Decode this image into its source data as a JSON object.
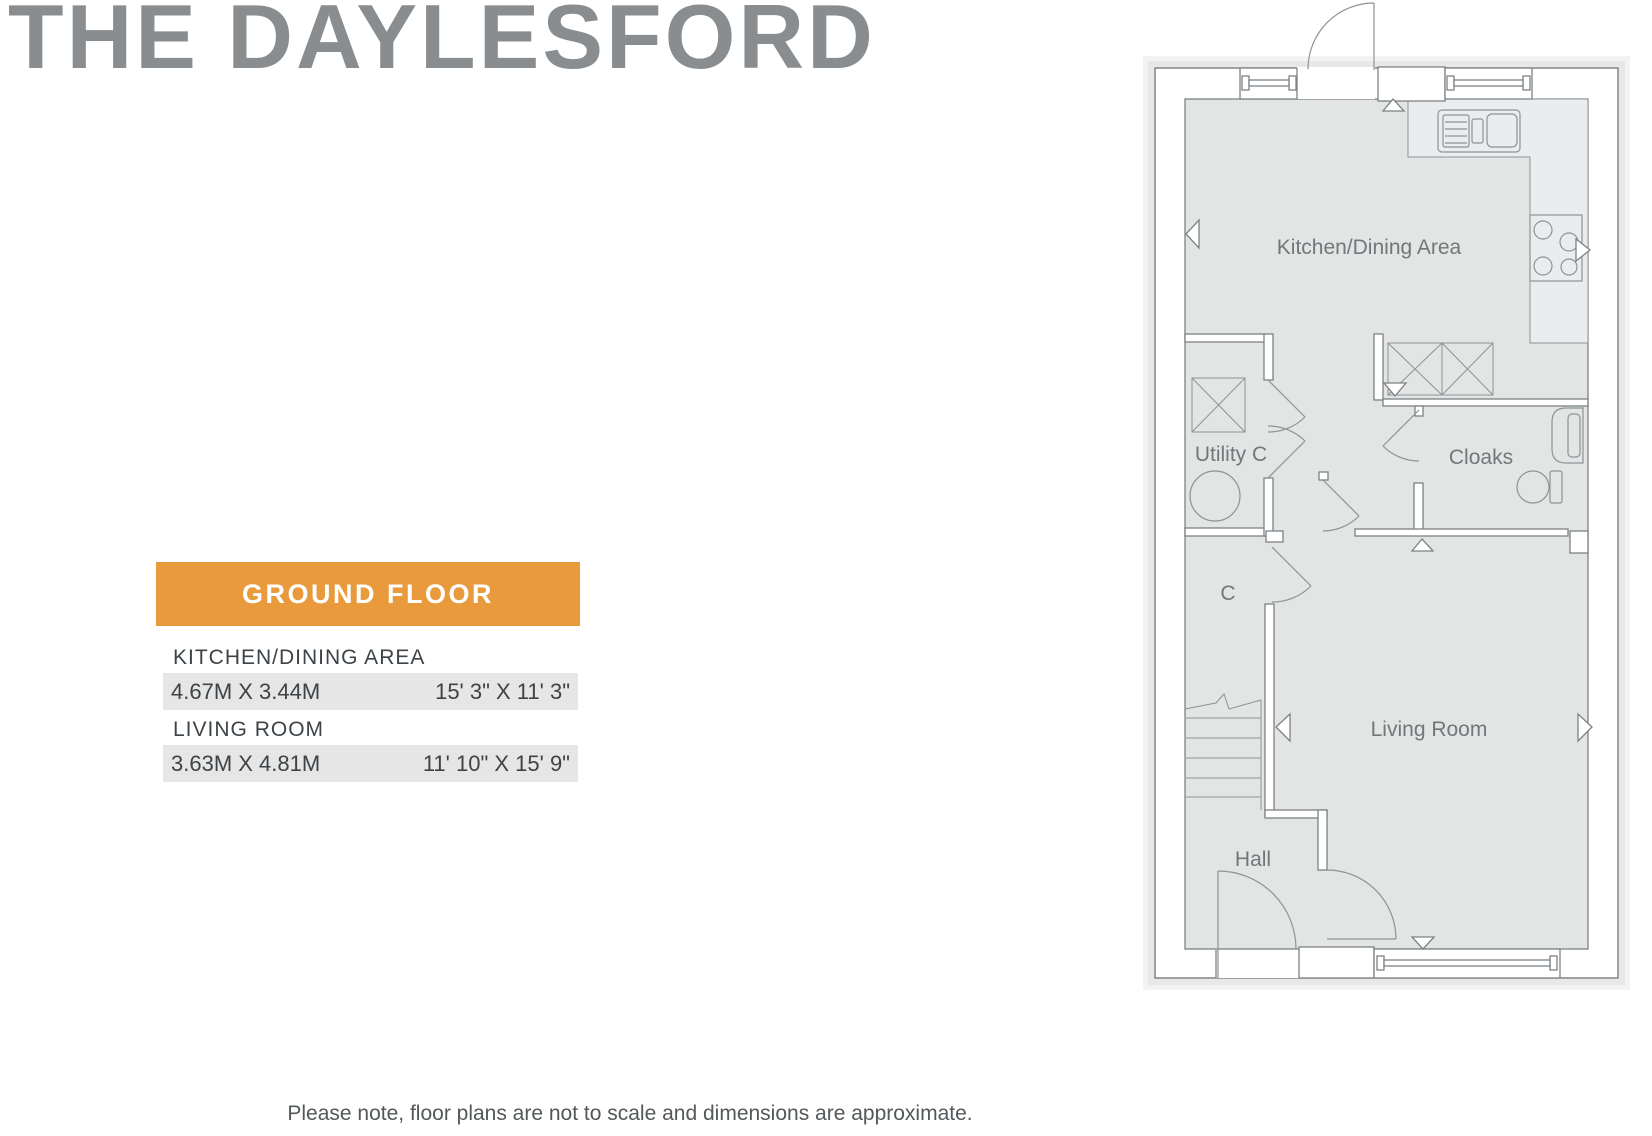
{
  "page": {
    "title": "THE DAYLESFORD",
    "note": "Please note, floor plans are not to scale and dimensions are approximate."
  },
  "panel": {
    "banner": "GROUND FLOOR",
    "rooms": [
      {
        "name": "KITCHEN/DINING AREA",
        "metric": "4.67M X 3.44M",
        "imperial": "15' 3\" X 11' 3\""
      },
      {
        "name": "LIVING ROOM",
        "metric": "3.63M X 4.81M",
        "imperial": "11' 10\" X 15' 9\""
      }
    ]
  },
  "plan": {
    "labels": {
      "kitchen": "Kitchen/Dining Area",
      "utility": "Utility C",
      "cloaks": "Cloaks",
      "cupboard": "C",
      "living": "Living Room",
      "hall": "Hall"
    }
  },
  "colors": {
    "accent_orange": "#e99a3c",
    "title_gray": "#898d8f",
    "row_bg": "#e5e6e5",
    "floor_fill": "#e3e4e4",
    "counter_fill": "#ebeced",
    "wall_stroke": "#7d8285",
    "fixture_stroke": "#8d9396",
    "label_gray": "#71777a",
    "text_dark": "#3e4347"
  }
}
